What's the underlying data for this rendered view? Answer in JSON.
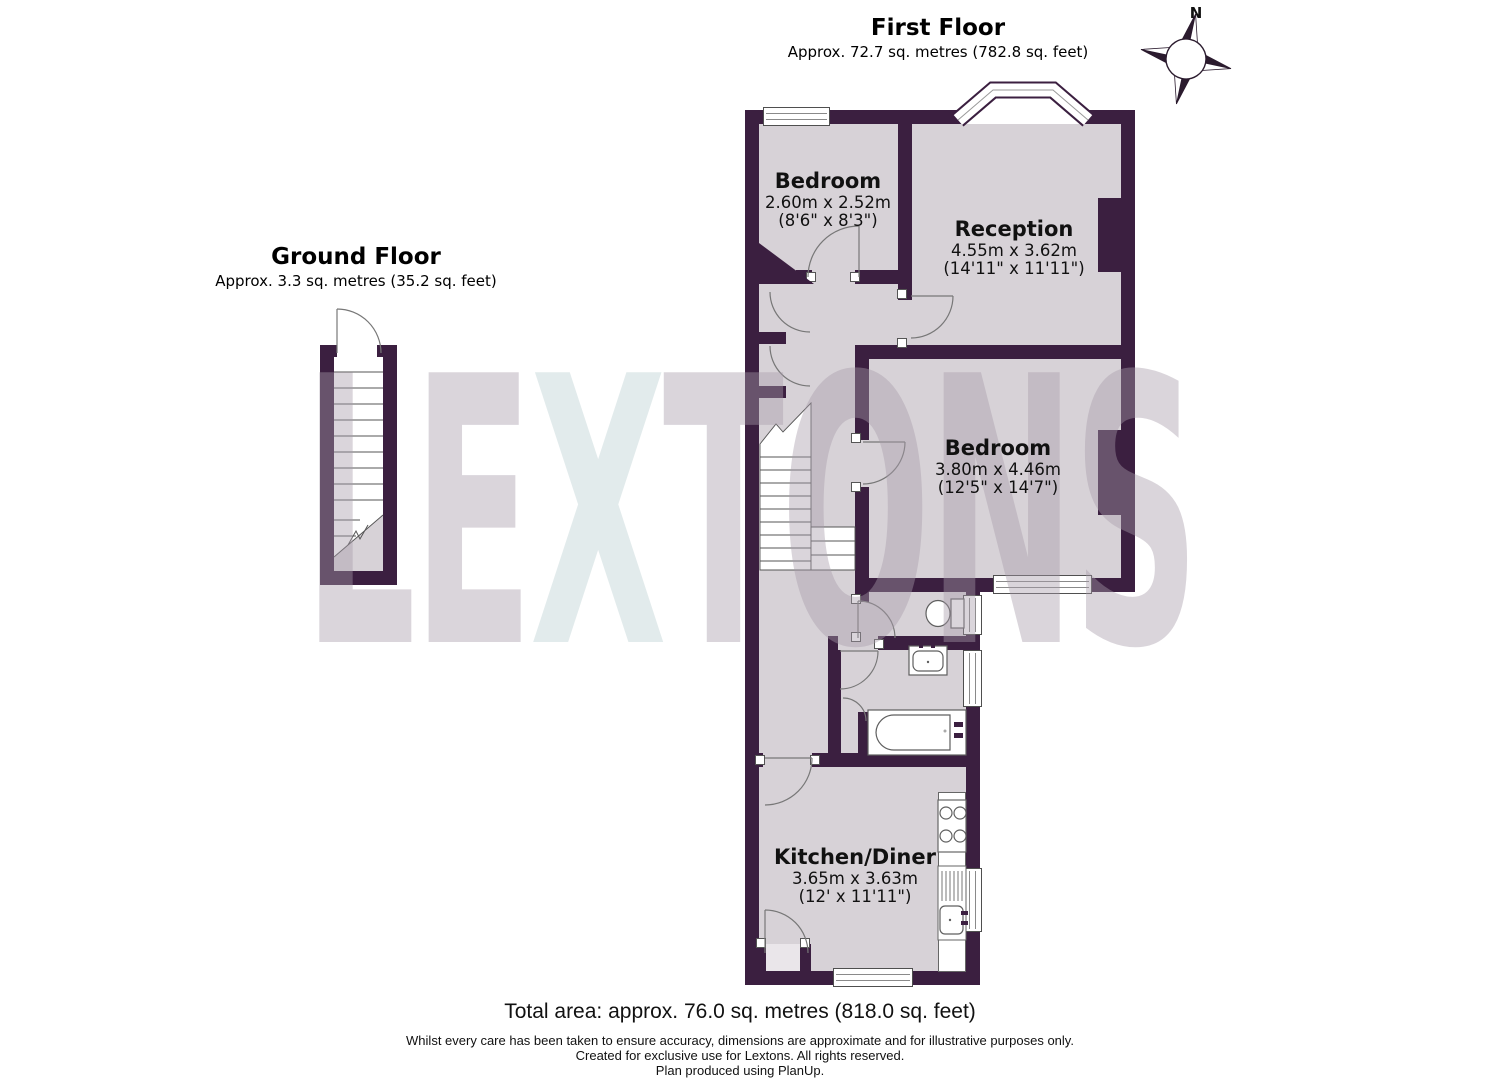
{
  "titles": {
    "first_floor": {
      "name": "First Floor",
      "area": "Approx. 72.7 sq. metres (782.8 sq. feet)"
    },
    "ground_floor": {
      "name": "Ground Floor",
      "area": "Approx. 3.3 sq. metres (35.2 sq. feet)"
    }
  },
  "compass": {
    "north_label": "N"
  },
  "rooms": [
    {
      "name": "Bedroom",
      "dim_metric": "2.60m x 2.52m",
      "dim_imperial": "(8'6\" x 8'3\")"
    },
    {
      "name": "Reception",
      "dim_metric": "4.55m x 3.62m",
      "dim_imperial": "(14'11\" x 11'11\")"
    },
    {
      "name": "Bedroom",
      "dim_metric": "3.80m x 4.46m",
      "dim_imperial": "(12'5\" x 14'7\")"
    },
    {
      "name": "Kitchen/Diner",
      "dim_metric": "3.65m x 3.63m",
      "dim_imperial": "(12' x 11'11\")"
    }
  ],
  "watermark": {
    "left": "LE",
    "x": "X",
    "right": "TONS"
  },
  "footer": {
    "total_area": "Total area: approx. 76.0 sq. metres (818.0 sq. feet)",
    "disclaimer1": "Whilst every care has been taken to ensure accuracy, dimensions are approximate and for illustrative purposes only.",
    "disclaimer2": "Created for exclusive use for Lextons. All rights reserved.",
    "disclaimer3": "Plan produced using PlanUp."
  },
  "colors": {
    "wall": "#3b1f40",
    "room": "#d7d2d7",
    "fixture_outline": "#5f5f5f",
    "watermark_grey": "rgba(168,156,170,0.42)",
    "watermark_x": "rgba(203,219,221,0.55)"
  }
}
